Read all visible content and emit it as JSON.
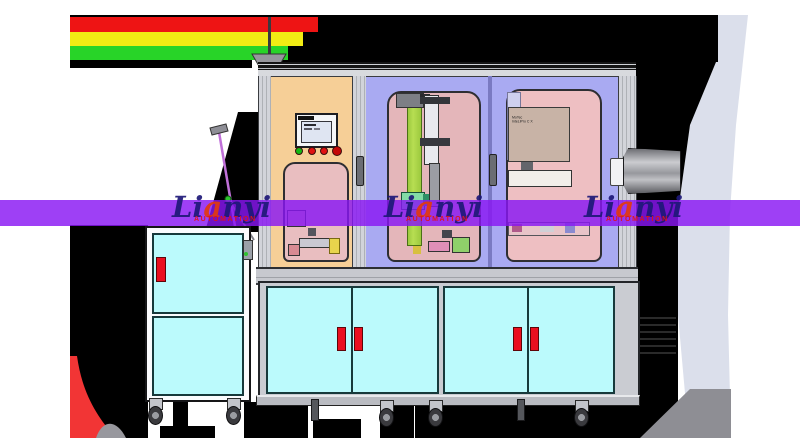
{
  "scene": {
    "title": "Lianyi automated assembly machine - CAD render",
    "background_color": "#ffffff"
  },
  "watermark": {
    "band_color": "#8916f3",
    "text_prefix": "Li",
    "text_accent": "a",
    "text_suffix": "nyi",
    "subtitle": "AUTOMATION",
    "text_color": "#1e1878",
    "accent_color": "#e23a0e",
    "subtitle_color": "#e01414",
    "instances": 3
  },
  "signal_tower": {
    "segments": [
      "red",
      "yellow",
      "green"
    ],
    "colors": {
      "red": "#ee1414",
      "yellow": "#f2ec14",
      "green": "#28d428"
    }
  },
  "machine": {
    "control_panel": {
      "type": "HMI touchscreen",
      "button_colors": [
        "#14b814",
        "#e01212",
        "#e01212",
        "#c40808"
      ]
    },
    "equipment_plate": {
      "label_line1": "MoTec",
      "label_line2": "InteLiPro C X"
    },
    "panel_colors": {
      "left_door": "#f6cf97",
      "center_door": "#a9aaf2",
      "right_door": "#a9aaf2",
      "window_pink": "#e7bcc0"
    },
    "lower_cabinet": {
      "door_color": "#bbfafc",
      "door_count": 4,
      "handle_color": "#ea0f1f"
    },
    "side_cabinet": {
      "door_color": "#bbfafc",
      "door_count": 2,
      "handle_color": "#ea0f1f"
    }
  }
}
